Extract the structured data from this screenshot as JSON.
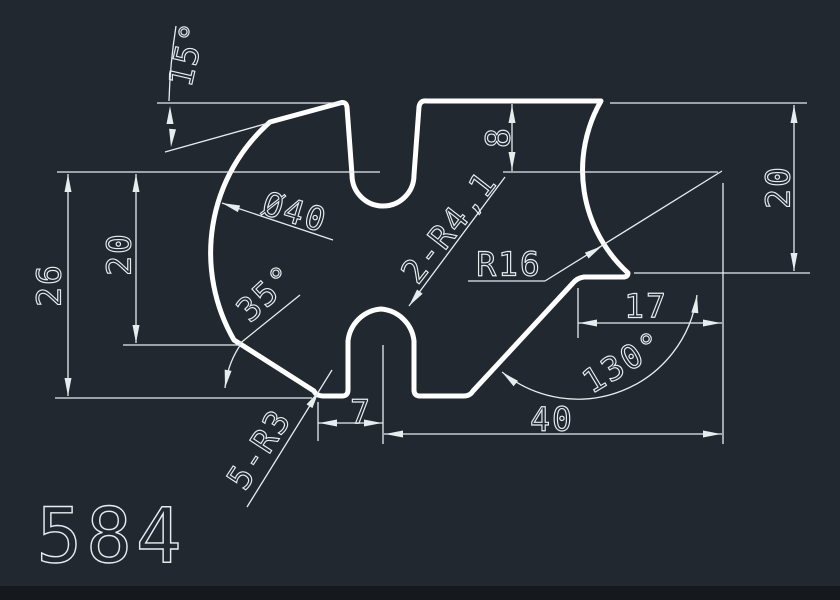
{
  "theme": {
    "background": "#212830",
    "part_line_color": "#ffffff",
    "dimension_color": "#e7ecef",
    "footer_strip_color": "#15191e"
  },
  "drawing": {
    "part_number": "584",
    "dimensions": {
      "angle_top": "15°",
      "diameter": "Ø40",
      "height_total": "26",
      "height_left": "20",
      "angle_left": "35°",
      "fillet_note": "5-R3",
      "radius_note": "2-R4,1",
      "radius_right": "R16",
      "depth_top": "8",
      "height_right": "20",
      "offset_right": "17",
      "angle_right": "130°",
      "width_small": "7",
      "width_main": "40"
    }
  }
}
